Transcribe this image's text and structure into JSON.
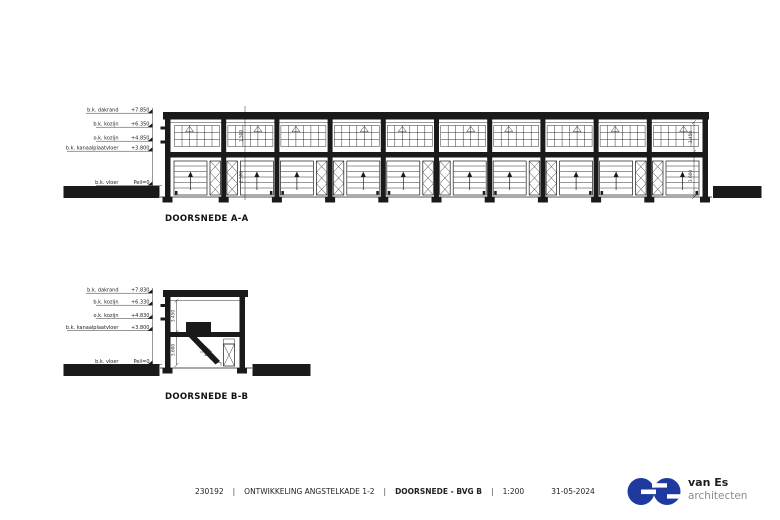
{
  "sections": {
    "a": {
      "title": "DOORSNEDE A-A",
      "bays": 10,
      "levels": [
        {
          "label": "b.k. dakrand",
          "value": "+7.850"
        },
        {
          "label": "b.k. kozijn",
          "value": "+6.350"
        },
        {
          "label": "o.k. kozijn",
          "value": "+4.850"
        },
        {
          "label": "b.k. kanaalplaatvloer",
          "value": "+3.800"
        },
        {
          "label": "b.k. vloer",
          "value": "Peil=0"
        }
      ],
      "dims": {
        "storey_upper": "3.450",
        "storey_lower": "3.600",
        "window_height": "1.500",
        "door_height": "2.500"
      }
    },
    "b": {
      "title": "DOORSNEDE B-B",
      "levels": [
        {
          "label": "b.k. dakrand",
          "value": "+7.830"
        },
        {
          "label": "b.k. kozijn",
          "value": "+6.330"
        },
        {
          "label": "o.k. kozijn",
          "value": "+4.830"
        },
        {
          "label": "b.k. kanaalplaatvloer",
          "value": "+3.800"
        },
        {
          "label": "b.k. vloer",
          "value": "Peil=0"
        }
      ],
      "dims": {
        "storey_upper": "3.450",
        "storey_lower": "3.600"
      }
    }
  },
  "footer": {
    "project_number": "230192",
    "separator": "|",
    "project_name": "ONTWIKKELING ANGSTELKADE 1-2",
    "drawing_title": "DOORSNEDE - BVG B",
    "scale": "1:200",
    "date": "31-05-2024"
  },
  "logo": {
    "company_line1": "van Es",
    "company_line2": "architecten",
    "blue": "#1e3a9f",
    "gray": "#8b8b8b"
  },
  "colors": {
    "ink": "#1a1a1a",
    "paper": "#ffffff"
  }
}
